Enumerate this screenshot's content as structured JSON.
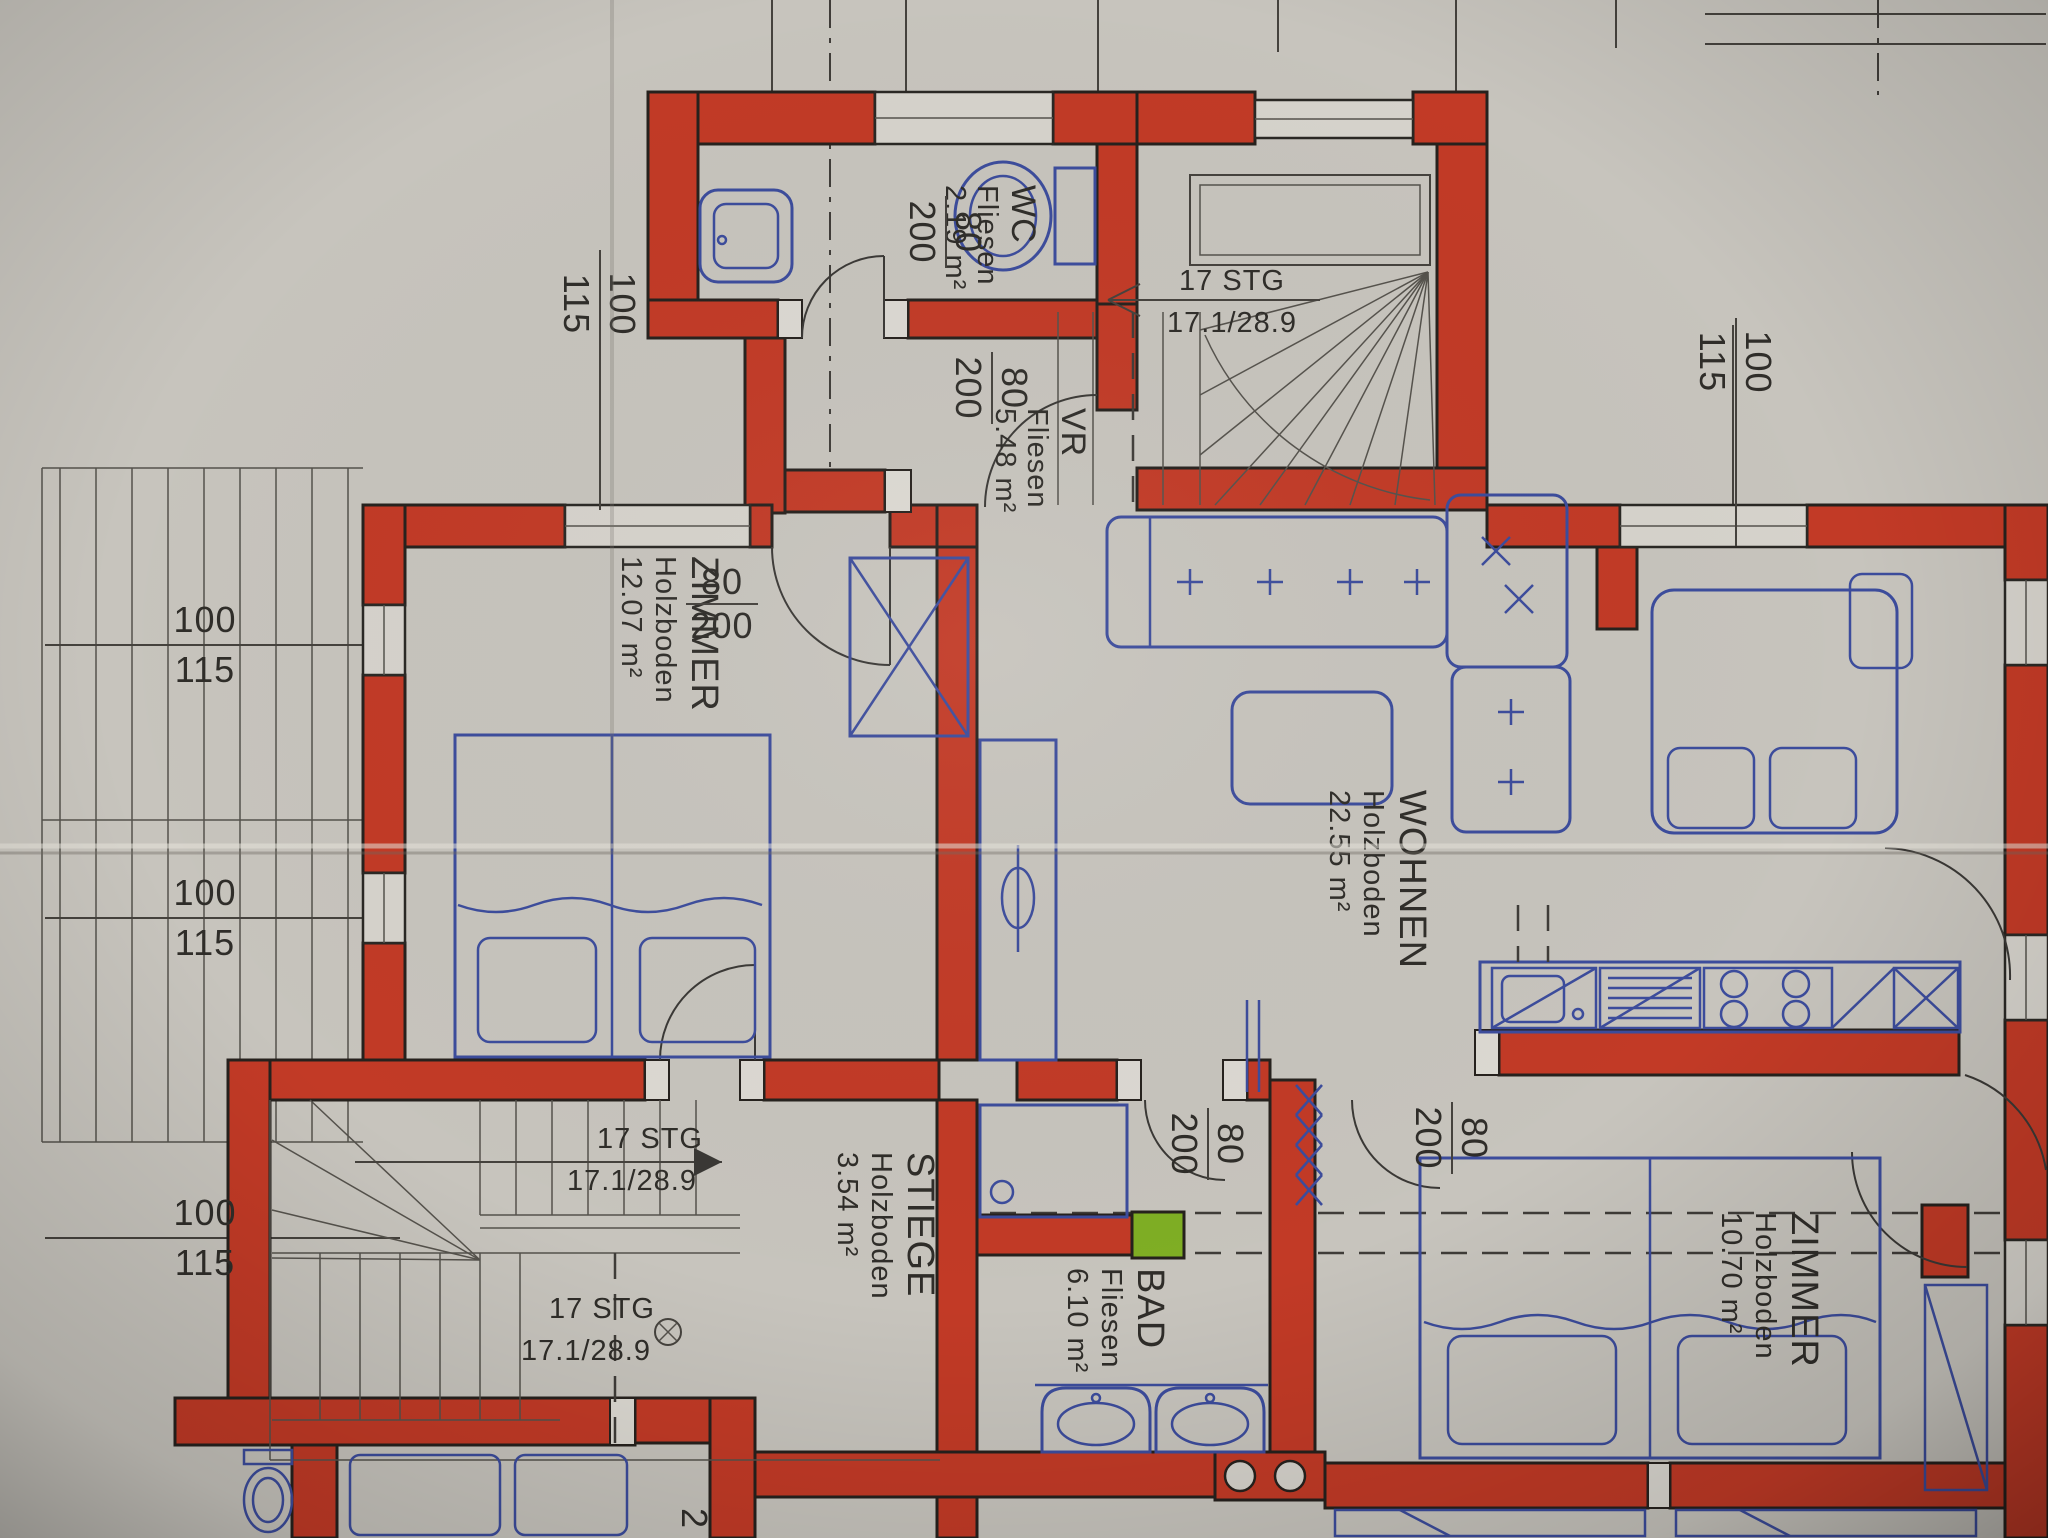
{
  "document": {
    "type": "floor-plan-photo"
  },
  "colors": {
    "paper": "#c7c4bd",
    "wall_red": "#c23a26",
    "furniture_blue": "#3c4c9c",
    "marker_green": "#7fae24",
    "line": "#3f3c38"
  },
  "rooms": {
    "wc": {
      "name": "WC",
      "floor": "Fliesen",
      "area": "2.19 m²"
    },
    "vr": {
      "name": "VR",
      "floor": "Fliesen",
      "area": "5.48 m²"
    },
    "zimmer_left": {
      "name": "ZIMMER",
      "floor": "Holzboden",
      "area": "12.07 m²"
    },
    "wohnen": {
      "name": "WOHNEN",
      "floor": "Holzboden",
      "area": "22.55 m²"
    },
    "stiege": {
      "name": "STIEGE",
      "floor": "Holzboden",
      "area": "3.54 m²"
    },
    "bad": {
      "name": "BAD",
      "floor": "Fliesen",
      "area": "6.10 m²"
    },
    "zimmer_right": {
      "name": "ZIMMER",
      "floor": "Holzboden",
      "area": "10.70 m²"
    }
  },
  "stairs": {
    "upper": {
      "steps": "17 STG",
      "dims": "17.1/28.9"
    },
    "lower_first": {
      "steps": "17 STG",
      "dims": "17.1/28.9"
    },
    "lower_second": {
      "steps": "17 STG",
      "dims": "17.1/28.9"
    }
  },
  "door_label": {
    "width": "80",
    "height": "200"
  },
  "window_label": {
    "width": "100",
    "height": "115"
  },
  "partial_dimension": "2"
}
